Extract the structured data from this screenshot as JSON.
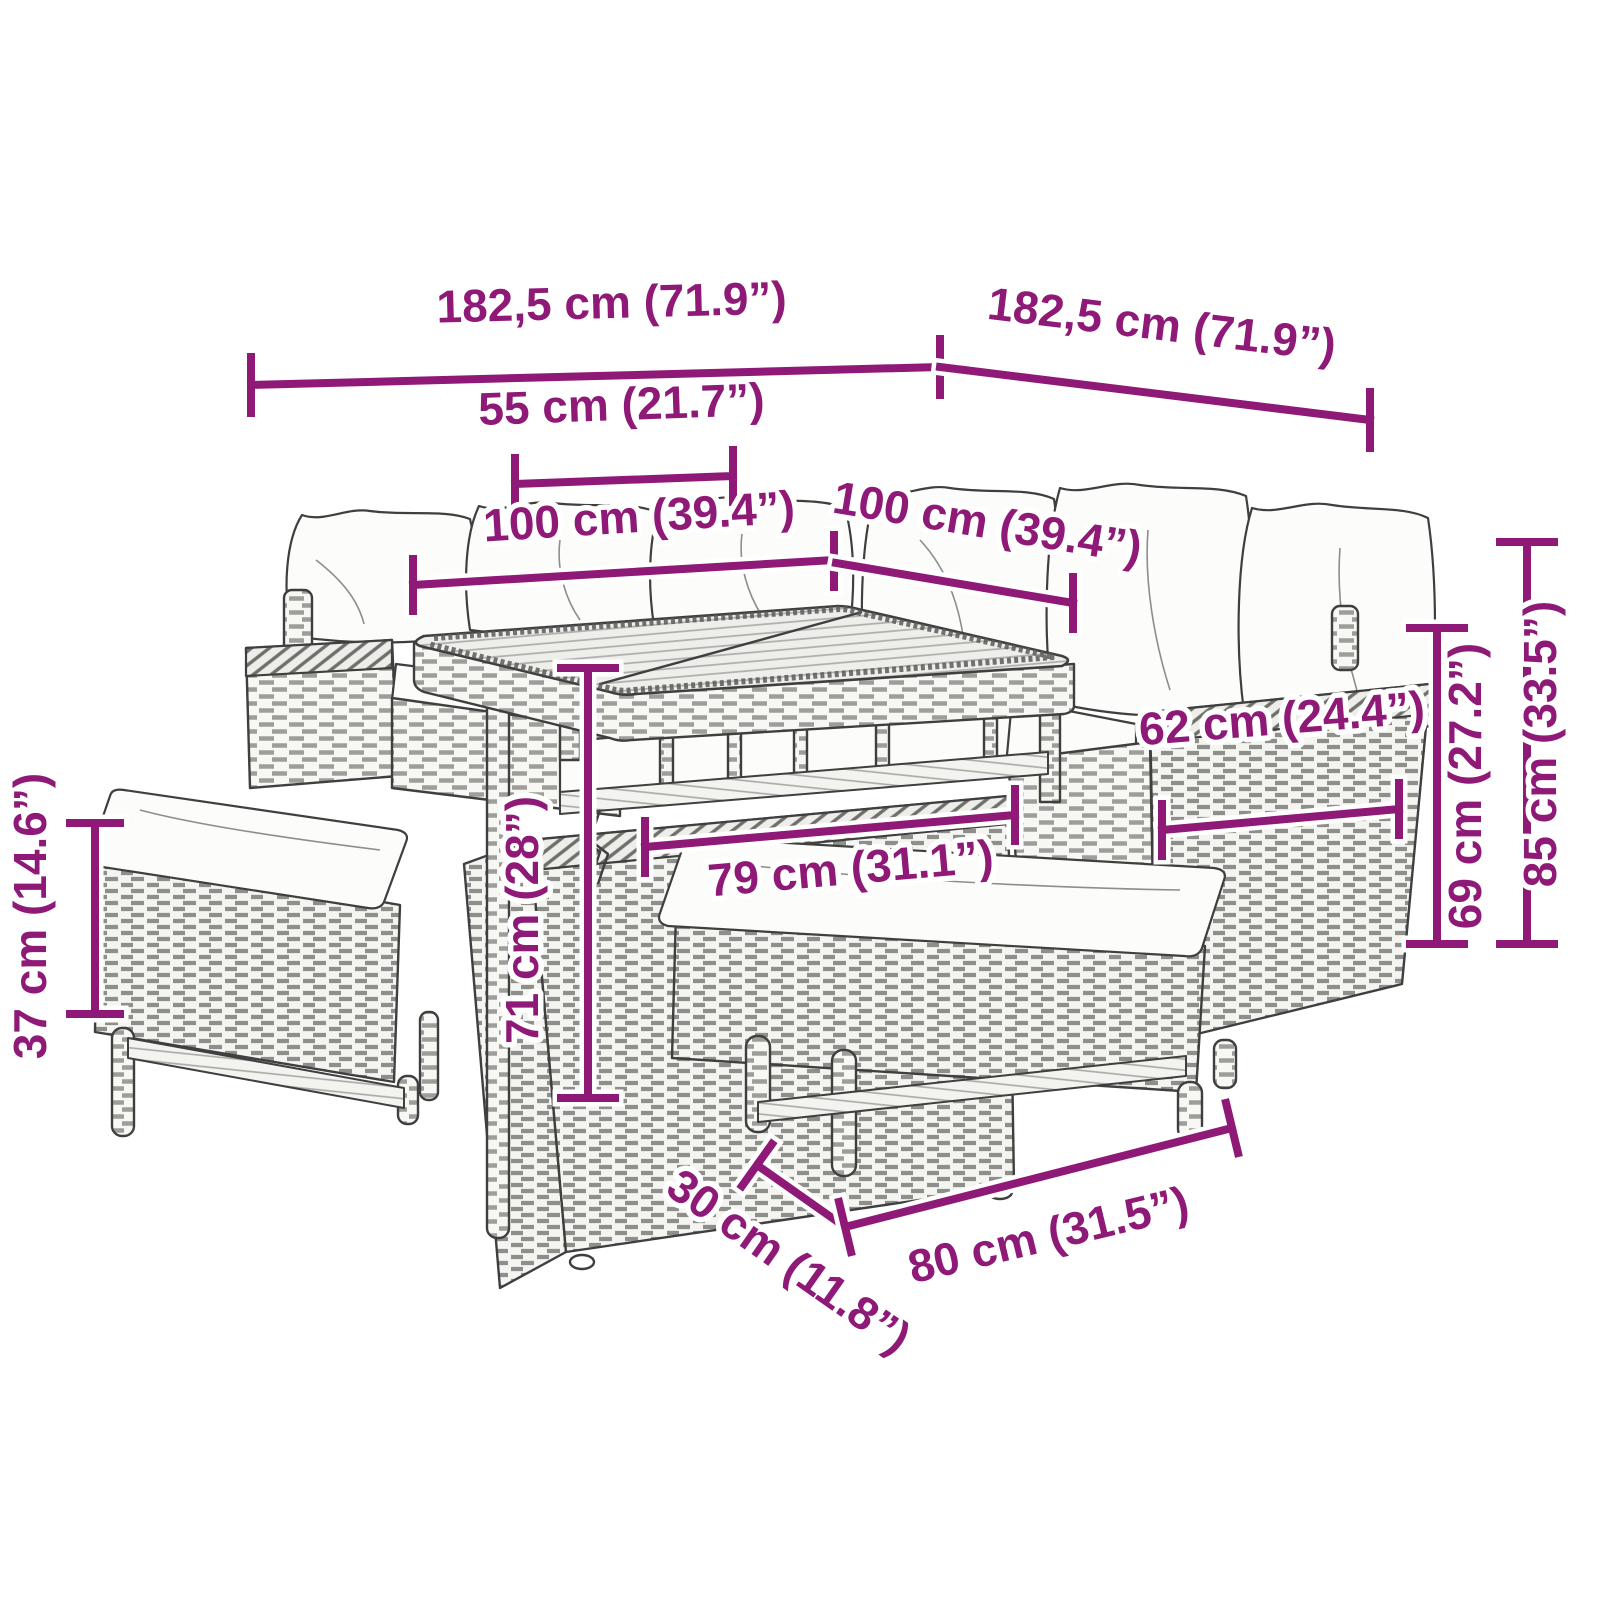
{
  "meta": {
    "title": "Garden furniture set — dimension diagram",
    "product": "Poly rattan corner sofa set with dining table, storage ottoman and two bench stools with cushions",
    "style": "black line-art product drawing with magenta dimension lines on white background"
  },
  "colors": {
    "dimension": "#8E1977",
    "line_art": "#3F3F3F",
    "background": "#FFFFFF",
    "cushion": "#FCFCFA"
  },
  "units": {
    "metric": "cm",
    "imperial": "in"
  },
  "dims": {
    "width_left": "182,5 cm (71.9”)",
    "width_right": "182,5 cm (71.9”)",
    "leg_span_55": "55 cm (21.7”)",
    "table_100_l": "100 cm (39.4”)",
    "table_100_r": "100 cm (39.4”)",
    "depth_62": "62 cm (24.4”)",
    "seat_h_69": "69 cm (27.2”)",
    "total_h_85": "85 cm (33.5”)",
    "table_h_71": "71 cm (28”)",
    "box_w_79": "79 cm (31.1”)",
    "bench_h_37": "37 cm (14.6”)",
    "bench_d_30": "30 cm (11.8”)",
    "bench_w_80": "80 cm (31.5”)"
  }
}
